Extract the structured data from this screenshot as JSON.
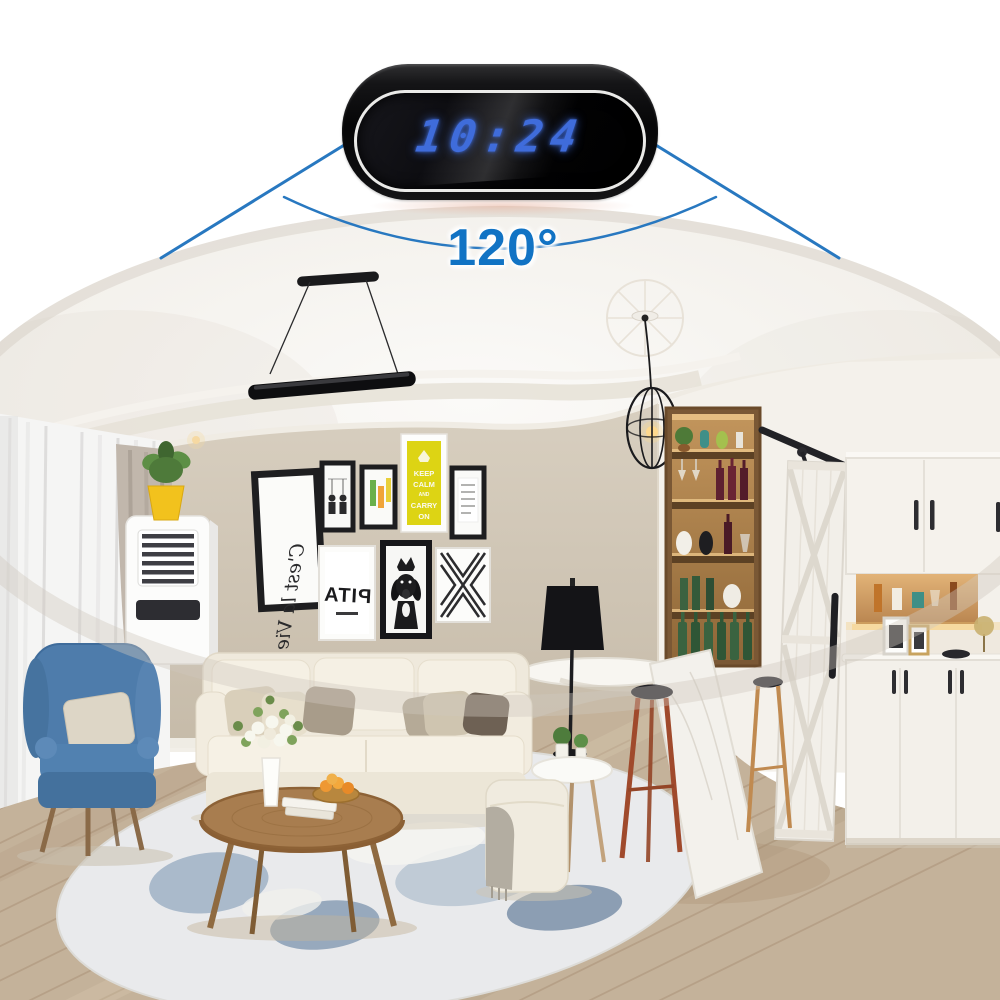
{
  "device": {
    "display_time": "10:24",
    "view_angle_label": "120°"
  },
  "colors": {
    "background": "#ffffff",
    "fov_line_blue": "#2878c0",
    "angle_text_blue": "#1173c4",
    "led_blue": "#3f6cdb",
    "clock_rim": "#eaeae8",
    "wall_beige": "#cfc5b4",
    "armchair_blue": "#4e7cab",
    "poster_yellow": "#ddd414",
    "wood_floor": "#c4b29a"
  },
  "posters": {
    "keep_calm_lines": [
      "KEEP",
      "CALM",
      "AND",
      "CARRY",
      "ON"
    ],
    "script_text": "C'est la Vie",
    "pita_text": "PITA"
  }
}
